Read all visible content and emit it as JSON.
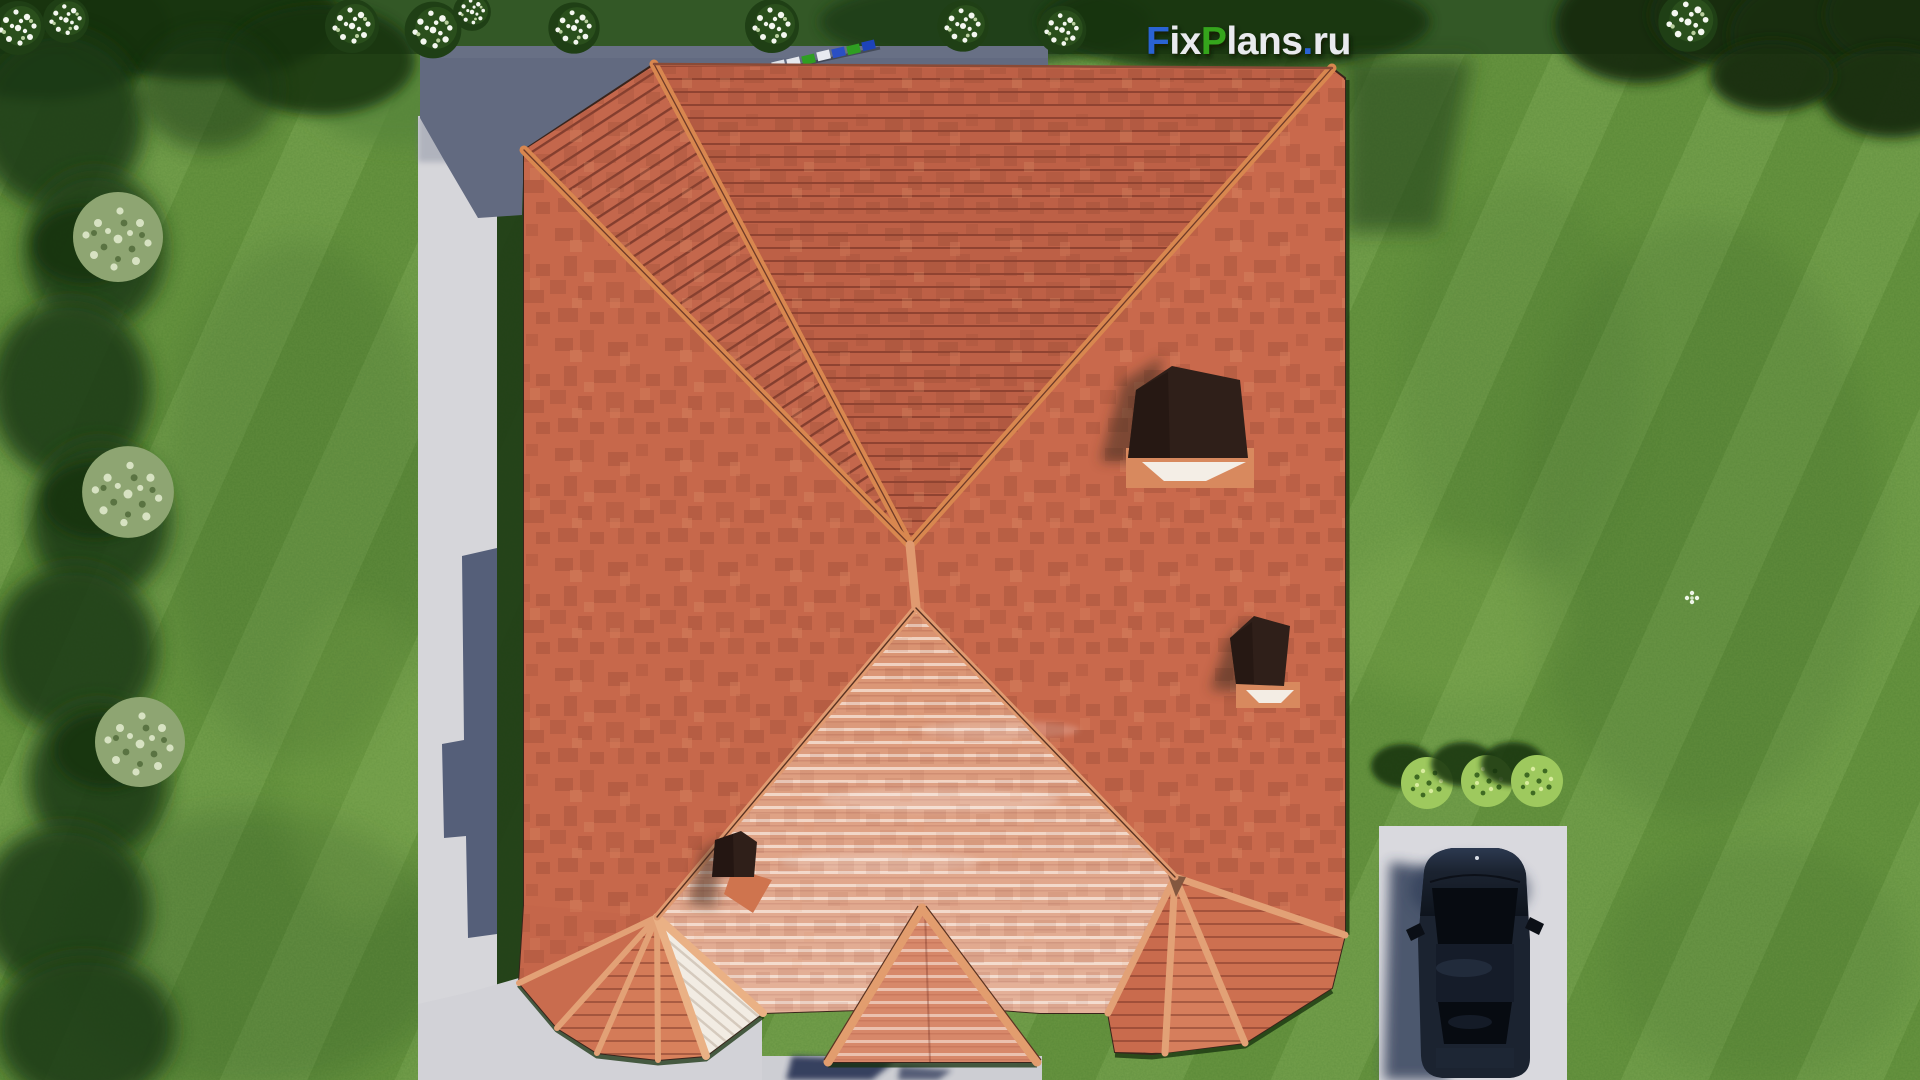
{
  "watermark": {
    "text": "FixPlans.ru",
    "segments": [
      {
        "text": "F",
        "color": "#2a63d4"
      },
      {
        "text": "ix",
        "color": "#e9eaee"
      },
      {
        "text": "P",
        "color": "#36a51f"
      },
      {
        "text": "lans",
        "color": "#e9eaee"
      },
      {
        "text": ".",
        "color": "#2a63d4"
      },
      {
        "text": "ru",
        "color": "#e9eaee"
      }
    ]
  },
  "palette": {
    "lawn": "#6f9c44",
    "lawnShadow": "#1e3c16",
    "roofBase": "#c7684b",
    "roofTop": "#bd6046",
    "roofLight": "#d9916f",
    "whiteFace": "#f2ece3",
    "ridge": "#e2a176",
    "path": "#d6d6da",
    "terrace": "#626a80",
    "pavement": "#d2d2d7",
    "parkingPad": "#d9d9de",
    "carBody": "#1b2330",
    "chimney": "#2f1f19"
  },
  "terrace_items": {
    "colors": [
      "#2a4fc4",
      "#e6e8ee",
      "#dfe3ea",
      "#e6e8ee",
      "#2f9e22",
      "#e8eaf0",
      "#2a4fc4",
      "#2f9e22",
      "#1d43b8"
    ]
  },
  "scene": {
    "description": "Aerial top-down 3D render of a house with a terracotta hip roof, lawn, garden path, terrace, parking pad with a dark car, shrubs and flowering bushes",
    "counts": {
      "chimneys": 3,
      "porch_roofs": 3,
      "flower_bushes": 10,
      "shrubs_left": 3,
      "shrubs_right": 3,
      "cars": 1
    }
  }
}
